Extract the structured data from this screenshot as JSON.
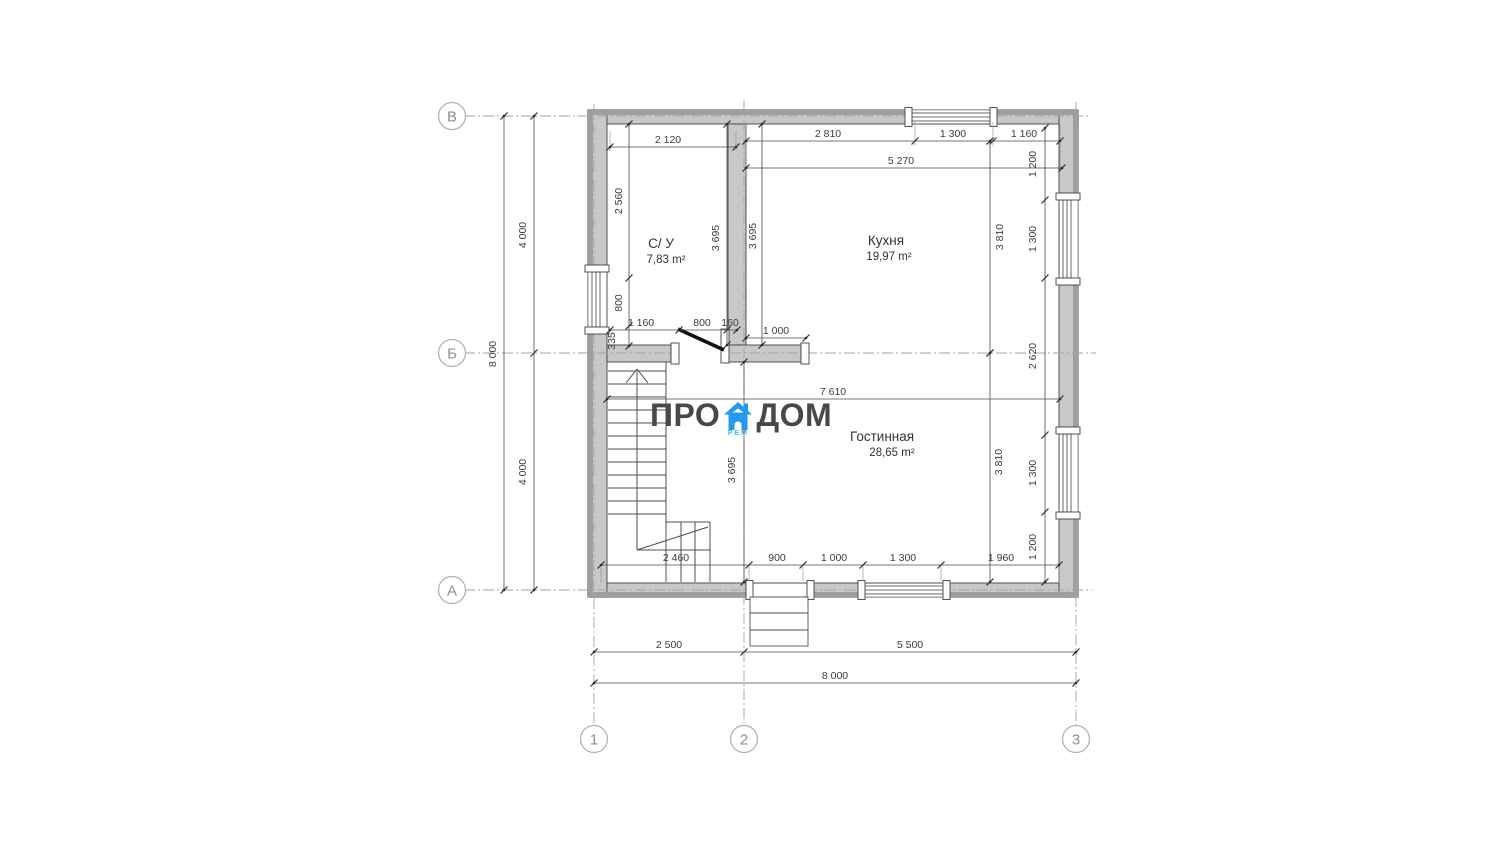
{
  "title": "Floor plan drawing — first floor",
  "logo": {
    "pro": "ПРО",
    "dom": "ДОМ",
    "rem": "РЕМ",
    "text_color": "#46494c",
    "accent": "#2599f0",
    "rem_color": "#3eb7f4"
  },
  "colors": {
    "wall_fill": "#c8c8c8",
    "wall_band": "#9e9e9e",
    "wall_stroke": "#414141",
    "dim_color": "#3c3c3c",
    "axis_color": "#a3a3a3",
    "circle_stroke": "#b3b3b3",
    "circle_text": "#8f8f8f",
    "thin_line": "#4f4f4f"
  },
  "rooms": [
    {
      "name": "С/ У",
      "area": "7,83 m²",
      "nx": 661,
      "ny": 248,
      "ax": 666,
      "ay": 263
    },
    {
      "name": "Кухня",
      "area": "19,97 m²",
      "nx": 886,
      "ny": 245,
      "ax": 889,
      "ay": 260
    },
    {
      "name": "Гостинная",
      "area": "28,65 m²",
      "nx": 882,
      "ny": 441,
      "ax": 892,
      "ay": 456
    }
  ],
  "grid": {
    "circles": [
      {
        "label": "В",
        "x": 452,
        "y": 116
      },
      {
        "label": "Б",
        "x": 452,
        "y": 353
      },
      {
        "label": "А",
        "x": 452,
        "y": 590
      },
      {
        "label": "1",
        "x": 594,
        "y": 739
      },
      {
        "label": "2",
        "x": 744,
        "y": 739
      },
      {
        "label": "3",
        "x": 1076,
        "y": 739
      }
    ]
  },
  "plan": {
    "walls": [
      [
        588,
        110,
        490,
        14
      ],
      [
        588,
        583,
        490,
        14
      ],
      [
        588,
        110,
        19,
        487
      ],
      [
        1059,
        110,
        19,
        487
      ],
      [
        728,
        124,
        18,
        221
      ],
      [
        607,
        345,
        64,
        17
      ],
      [
        728,
        345,
        73,
        17
      ]
    ],
    "bands": [
      [
        588,
        110,
        490,
        5
      ],
      [
        588,
        592,
        490,
        5
      ],
      [
        588,
        110,
        5,
        487
      ],
      [
        1073,
        110,
        5,
        487
      ]
    ],
    "openings": [
      [
        588.5,
        272,
        18,
        55
      ],
      [
        912,
        110.5,
        78,
        13
      ],
      [
        1059.5,
        200,
        18,
        78
      ],
      [
        1059.5,
        434,
        18,
        78
      ],
      [
        865,
        583.5,
        78,
        13
      ],
      [
        753,
        583.5,
        54,
        13
      ],
      [
        679,
        345.5,
        42,
        16
      ]
    ],
    "glass": [
      {
        "rect": [
          592,
          272,
          8,
          55
        ],
        "mid": [
          596,
          272,
          596,
          327
        ]
      },
      {
        "rect": [
          912,
          113,
          78,
          8
        ],
        "mid": [
          912,
          117,
          990,
          117
        ]
      },
      {
        "rect": [
          1063,
          200,
          8,
          78
        ],
        "mid": [
          1067,
          200,
          1067,
          278
        ]
      },
      {
        "rect": [
          1063,
          434,
          8,
          78
        ],
        "mid": [
          1067,
          434,
          1067,
          512
        ]
      },
      {
        "rect": [
          865,
          586,
          78,
          8
        ],
        "mid": [
          865,
          590,
          943,
          590
        ]
      }
    ],
    "caps": [
      [
        585,
        265,
        24,
        7
      ],
      [
        585,
        327,
        24,
        7
      ],
      [
        905,
        107.5,
        7,
        19
      ],
      [
        990,
        107.5,
        7,
        19
      ],
      [
        1056,
        193,
        24,
        7
      ],
      [
        1056,
        278,
        24,
        7
      ],
      [
        1056,
        427,
        24,
        7
      ],
      [
        1056,
        512,
        24,
        7
      ],
      [
        858,
        580.5,
        7,
        19
      ],
      [
        943,
        580.5,
        7,
        19
      ],
      [
        746,
        580.5,
        7,
        19
      ],
      [
        807,
        580.5,
        7,
        19
      ],
      [
        671,
        343,
        8,
        21
      ],
      [
        721,
        329,
        8,
        34
      ],
      [
        801,
        343,
        8,
        21
      ]
    ],
    "swings": [
      [
        757,
        612,
        806,
        598
      ],
      [
        678,
        329,
        724,
        350
      ]
    ],
    "stair_lines": [
      [
        666,
        362,
        666,
        582
      ],
      [
        608,
        371,
        666,
        371
      ],
      [
        608,
        384,
        666,
        384
      ],
      [
        608,
        397,
        666,
        397
      ],
      [
        608,
        410,
        666,
        410
      ],
      [
        608,
        423,
        666,
        423
      ],
      [
        608,
        436,
        666,
        436
      ],
      [
        608,
        449,
        666,
        449
      ],
      [
        608,
        462,
        666,
        462
      ],
      [
        608,
        475,
        666,
        475
      ],
      [
        608,
        488,
        666,
        488
      ],
      [
        608,
        501,
        666,
        501
      ],
      [
        608,
        514,
        666,
        514
      ],
      [
        666,
        522,
        710,
        522
      ],
      [
        710,
        522,
        710,
        582
      ],
      [
        681,
        522,
        681,
        582
      ],
      [
        695,
        522,
        695,
        582
      ],
      [
        637,
        550,
        710,
        550
      ],
      [
        637,
        372,
        637,
        550
      ],
      [
        637,
        550,
        708,
        527
      ],
      [
        637,
        369,
        626,
        383
      ],
      [
        637,
        369,
        648,
        383
      ]
    ],
    "porch": {
      "rect": [
        750,
        597,
        58,
        49
      ],
      "lines": [
        [
          750,
          613,
          808,
          613
        ],
        [
          750,
          630,
          808,
          630
        ]
      ]
    },
    "axes": [
      [
        464,
        116,
        1091,
        116
      ],
      [
        464,
        353,
        1096,
        353
      ],
      [
        464,
        590,
        1092,
        590
      ],
      [
        594,
        104,
        594,
        726
      ],
      [
        744,
        100,
        744,
        726
      ],
      [
        1076,
        102,
        1076,
        726
      ]
    ],
    "ext_lines": [
      [
        746,
        124,
        746,
        172
      ],
      [
        915,
        122,
        915,
        146
      ],
      [
        993,
        122,
        993,
        146
      ],
      [
        1060,
        124,
        1060,
        172
      ],
      [
        610,
        131,
        610,
        151
      ],
      [
        736,
        131,
        736,
        151
      ],
      [
        601,
        565,
        601,
        583
      ],
      [
        749,
        565,
        749,
        581
      ],
      [
        803,
        565,
        803,
        581
      ],
      [
        863,
        565,
        863,
        581
      ],
      [
        941,
        565,
        941,
        581
      ],
      [
        1059,
        565,
        1059,
        583
      ]
    ],
    "dim_lines": [
      {
        "l": [
          746,
          141,
          1060,
          141
        ],
        "ticks": [
          [
            746,
            141
          ],
          [
            915,
            141
          ],
          [
            993,
            141
          ],
          [
            1060,
            141
          ]
        ]
      },
      {
        "l": [
          746,
          168,
          1062,
          168
        ],
        "ticks": [
          [
            746,
            168
          ],
          [
            1062,
            168
          ]
        ]
      },
      {
        "l": [
          610,
          147,
          736,
          147
        ],
        "ticks": [
          [
            610,
            147
          ],
          [
            736,
            147
          ]
        ]
      },
      {
        "l": [
          629,
          124,
          629,
          346
        ],
        "ticks": [
          [
            629,
            124
          ],
          [
            629,
            278
          ],
          [
            629,
            326
          ],
          [
            629,
            346
          ]
        ]
      },
      {
        "l": [
          610,
          330,
          737,
          330
        ],
        "ticks": [
          [
            610,
            330
          ],
          [
            679,
            330
          ],
          [
            727,
            330
          ],
          [
            737,
            330
          ]
        ]
      },
      {
        "l": [
          727,
          124,
          727,
          345
        ],
        "ticks": [
          [
            727,
            124
          ],
          [
            727,
            345
          ]
        ]
      },
      {
        "l": [
          762,
          124,
          762,
          345
        ],
        "ticks": [
          [
            762,
            124
          ],
          [
            762,
            345
          ]
        ]
      },
      {
        "l": [
          990,
          141,
          990,
          353
        ],
        "ticks": [
          [
            990,
            141
          ],
          [
            990,
            353
          ]
        ]
      },
      {
        "l": [
          1045,
          128,
          1045,
          582
        ],
        "ticks": [
          [
            1045,
            128
          ],
          [
            1045,
            200
          ],
          [
            1045,
            278
          ],
          [
            1045,
            435
          ],
          [
            1045,
            512
          ],
          [
            1045,
            582
          ]
        ]
      },
      {
        "l": [
          746,
          338,
          806,
          338
        ],
        "ticks": [
          [
            746,
            338
          ],
          [
            806,
            338
          ]
        ]
      },
      {
        "l": [
          607,
          399,
          1060,
          399
        ],
        "ticks": [
          [
            607,
            399
          ],
          [
            1060,
            399
          ]
        ]
      },
      {
        "l": [
          744,
          362,
          744,
          582
        ],
        "ticks": [
          [
            744,
            362
          ],
          [
            744,
            582
          ]
        ]
      },
      {
        "l": [
          990,
          353,
          990,
          582
        ],
        "ticks": [
          [
            990,
            353
          ],
          [
            990,
            582
          ]
        ]
      },
      {
        "l": [
          601,
          565,
          1059,
          565
        ],
        "ticks": [
          [
            601,
            565
          ],
          [
            749,
            565
          ],
          [
            803,
            565
          ],
          [
            863,
            565
          ],
          [
            941,
            565
          ],
          [
            1059,
            565
          ]
        ]
      },
      {
        "l": [
          534,
          116,
          534,
          590
        ],
        "ticks": [
          [
            534,
            116
          ],
          [
            534,
            353
          ],
          [
            534,
            590
          ]
        ]
      },
      {
        "l": [
          504,
          116,
          504,
          590
        ],
        "ticks": [
          [
            504,
            116
          ],
          [
            504,
            590
          ]
        ]
      },
      {
        "l": [
          594,
          652,
          1076,
          652
        ],
        "ticks": [
          [
            594,
            652
          ],
          [
            744,
            652
          ],
          [
            1076,
            652
          ]
        ]
      },
      {
        "l": [
          594,
          683,
          1076,
          683
        ],
        "ticks": [
          [
            594,
            683
          ],
          [
            1076,
            683
          ]
        ]
      }
    ],
    "dim_labels": [
      {
        "t": "2 120",
        "x": 668,
        "y": 143,
        "r": 0
      },
      {
        "t": "2 810",
        "x": 828,
        "y": 137,
        "r": 0
      },
      {
        "t": "1 300",
        "x": 953,
        "y": 137,
        "r": 0
      },
      {
        "t": "1 160",
        "x": 1024,
        "y": 137,
        "r": 0
      },
      {
        "t": "5 270",
        "x": 901,
        "y": 164,
        "r": 0
      },
      {
        "t": "1 200",
        "x": 1036,
        "y": 164,
        "r": 1
      },
      {
        "t": "1 300",
        "x": 1036,
        "y": 239,
        "r": 1
      },
      {
        "t": "2 620",
        "x": 1036,
        "y": 356,
        "r": 1
      },
      {
        "t": "1 300",
        "x": 1036,
        "y": 473,
        "r": 1
      },
      {
        "t": "1 200",
        "x": 1036,
        "y": 547,
        "r": 1
      },
      {
        "t": "2 560",
        "x": 622,
        "y": 201,
        "r": 1
      },
      {
        "t": "800",
        "x": 622,
        "y": 303,
        "r": 1
      },
      {
        "t": "335",
        "x": 615,
        "y": 341,
        "r": 1
      },
      {
        "t": "1 160",
        "x": 641,
        "y": 326,
        "r": 0
      },
      {
        "t": "800",
        "x": 702,
        "y": 326,
        "r": 0
      },
      {
        "t": "160",
        "x": 730,
        "y": 326,
        "r": 0
      },
      {
        "t": "3 695",
        "x": 719,
        "y": 238,
        "r": 1
      },
      {
        "t": "3 695",
        "x": 756,
        "y": 236,
        "r": 1
      },
      {
        "t": "3 810",
        "x": 1003,
        "y": 237,
        "r": 1
      },
      {
        "t": "1 000",
        "x": 776,
        "y": 334,
        "r": 0
      },
      {
        "t": "7 610",
        "x": 833,
        "y": 395,
        "r": 0
      },
      {
        "t": "3 695",
        "x": 735,
        "y": 470,
        "r": 1
      },
      {
        "t": "3 810",
        "x": 1002,
        "y": 462,
        "r": 1
      },
      {
        "t": "2 460",
        "x": 676,
        "y": 561,
        "r": 0
      },
      {
        "t": "900",
        "x": 777,
        "y": 561,
        "r": 0
      },
      {
        "t": "1 000",
        "x": 834,
        "y": 561,
        "r": 0
      },
      {
        "t": "1 300",
        "x": 903,
        "y": 561,
        "r": 0
      },
      {
        "t": "1 960",
        "x": 1001,
        "y": 561,
        "r": 0
      },
      {
        "t": "4 000",
        "x": 526,
        "y": 235,
        "r": 1
      },
      {
        "t": "8 000",
        "x": 496,
        "y": 354,
        "r": 1
      },
      {
        "t": "4 000",
        "x": 526,
        "y": 472,
        "r": 1
      },
      {
        "t": "2 500",
        "x": 669,
        "y": 648,
        "r": 0
      },
      {
        "t": "5 500",
        "x": 910,
        "y": 648,
        "r": 0
      },
      {
        "t": "8 000",
        "x": 835,
        "y": 679,
        "r": 0
      }
    ]
  }
}
